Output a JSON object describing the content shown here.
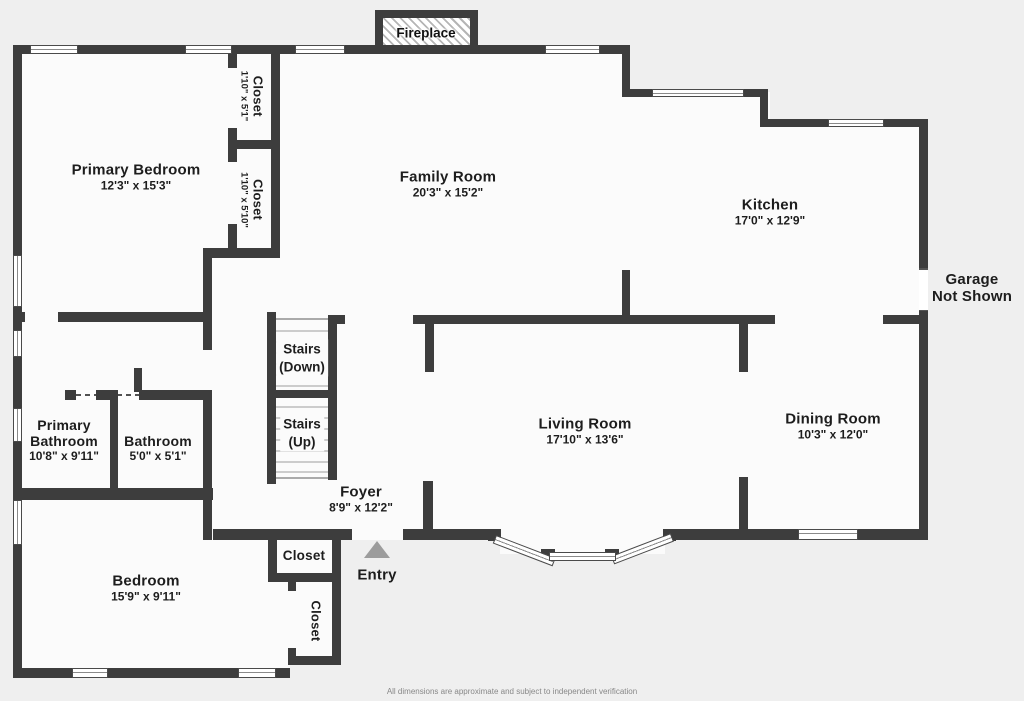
{
  "colors": {
    "wall": "#3d3d3d",
    "floor": "#fbfbfb",
    "background": "#efefef",
    "entry_triangle": "#9c9c9c"
  },
  "fireplace": {
    "label": "Fireplace"
  },
  "rooms": {
    "primary_bedroom": {
      "name": "Primary Bedroom",
      "dims": "12'3\" x 15'3\""
    },
    "family_room": {
      "name": "Family Room",
      "dims": "20'3\" x 15'2\""
    },
    "kitchen": {
      "name": "Kitchen",
      "dims": "17'0\" x 12'9\""
    },
    "living_room": {
      "name": "Living Room",
      "dims": "17'10\" x 13'6\""
    },
    "dining_room": {
      "name": "Dining Room",
      "dims": "10'3\" x 12'0\""
    },
    "primary_bathroom": {
      "name": "Primary Bathroom",
      "dims": "10'8\" x 9'11\""
    },
    "bathroom": {
      "name": "Bathroom",
      "dims": "5'0\" x 5'1\""
    },
    "foyer": {
      "name": "Foyer",
      "dims": "8'9\" x 12'2\""
    },
    "bedroom": {
      "name": "Bedroom",
      "dims": "15'9\" x 9'11\""
    },
    "closet_upper_1": {
      "name": "Closet",
      "dims": "1'10\" x 5'1\""
    },
    "closet_upper_2": {
      "name": "Closet",
      "dims": "1'10\" x 5'10\""
    },
    "closet_foyer": {
      "name": "Closet"
    },
    "closet_lower": {
      "name": "Closet"
    }
  },
  "stairs": {
    "down": {
      "line1": "Stairs",
      "line2": "(Down)"
    },
    "up": {
      "line1": "Stairs",
      "line2": "(Up)"
    }
  },
  "annotations": {
    "garage_line1": "Garage",
    "garage_line2": "Not Shown",
    "entry": "Entry",
    "disclaimer": "All dimensions are approximate and subject to independent verification"
  }
}
